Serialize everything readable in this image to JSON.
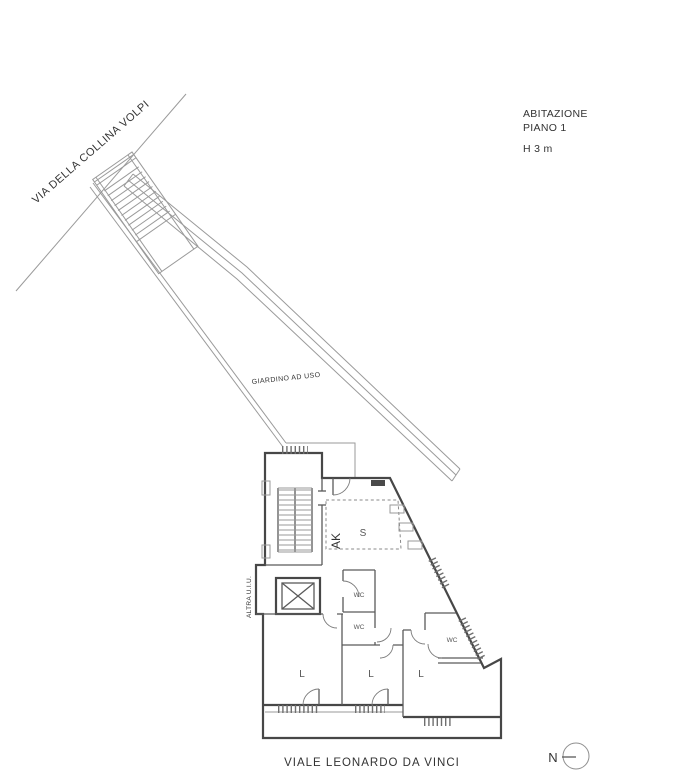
{
  "colors": {
    "background": "#ffffff",
    "thin_line": "#9a9a9a",
    "wall_line": "#474747",
    "text": "#333333"
  },
  "annotations": {
    "title": "ABITAZIONE",
    "floor": "PIANO 1",
    "height": "H 3 m"
  },
  "streets": {
    "top": "VIA DELLA COLLINA VOLPI",
    "bottom": "VIALE LEONARDO DA VINCI"
  },
  "areas": {
    "garden": "GIARDINO AD USO",
    "adjacent_unit": "ALTRA U.I.U.",
    "kitchenette": "AK",
    "living": "S",
    "wc": [
      "WC",
      "WC",
      "WC"
    ],
    "bedrooms": [
      "L",
      "L",
      "L"
    ]
  },
  "compass": {
    "north": "N"
  }
}
